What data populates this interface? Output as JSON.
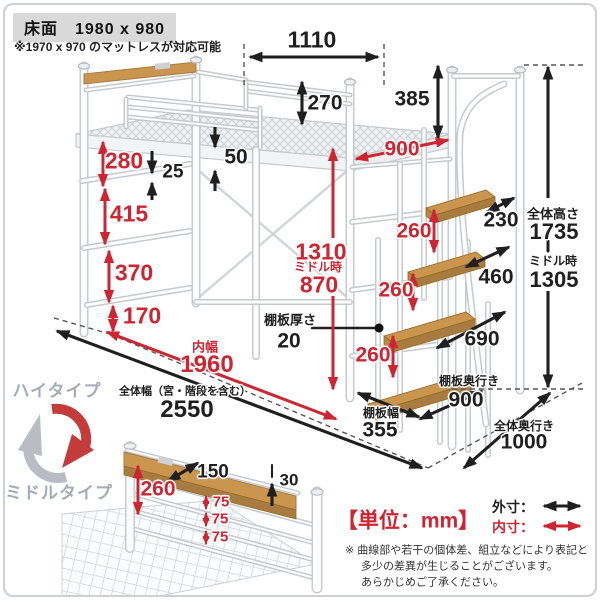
{
  "header": {
    "title": "床面　1980 x 980",
    "subnote": "※1970 x 970 のマットレスが対応可能"
  },
  "bed": {
    "top_opening_width": "1110",
    "guard_rail_height": "270",
    "post_above_deck": "385",
    "deck_inner_depth": "900",
    "ladder_top_gap": "280",
    "rung_thickness": "25",
    "deck_frame_thickness": "50",
    "ladder_gap_2": "415",
    "ladder_gap_3": "370",
    "ladder_bottom_gap": "170",
    "under_clearance_high": "1310",
    "under_clearance_middle_label": "ミドル時",
    "under_clearance_middle": "870",
    "shelf_thickness_label": "棚板厚さ",
    "shelf_thickness": "20"
  },
  "stairs": {
    "riser_1": "260",
    "riser_2": "260",
    "riser_3": "260",
    "tread_depth_1": "230",
    "tread_depth_2": "460",
    "tread_depth_3": "690",
    "tread_depth_4_label": "棚板奥行き",
    "tread_depth_4": "900",
    "tread_width_label": "棚板幅",
    "tread_width": "355"
  },
  "overall": {
    "height_label": "全体高さ",
    "height": "1735",
    "height_middle_label": "ミドル時",
    "height_middle": "1305",
    "inner_width_label": "内幅",
    "inner_width": "1960",
    "width_label": "全体幅（宮・階段を含む）",
    "width": "2550",
    "depth_label": "全体奥行き",
    "depth": "1000"
  },
  "headboard_detail": {
    "shelf_depth": "150",
    "board_thickness": "30",
    "height": "260",
    "slat_gap_1": "75",
    "slat_gap_2": "75",
    "slat_gap_3": "75"
  },
  "type_toggle": {
    "high": "ハイタイプ",
    "middle": "ミドルタイプ"
  },
  "legend": {
    "unit": "【単位：mm】",
    "outer_label": "外寸：",
    "inner_label": "内寸："
  },
  "footnote": {
    "line1": "※ 曲線部や若干の個体差、組立などにより表記と",
    "line2": "多少の差異が生じることがございます。",
    "line3": "あらかじめご了承ください。"
  },
  "colors": {
    "outer_dim": "#1f1f1f",
    "inner_dim": "#cc2633",
    "wood": "#c9954f",
    "frame_gray": "#c6cacd",
    "header_bg": "#d9d9d9"
  }
}
